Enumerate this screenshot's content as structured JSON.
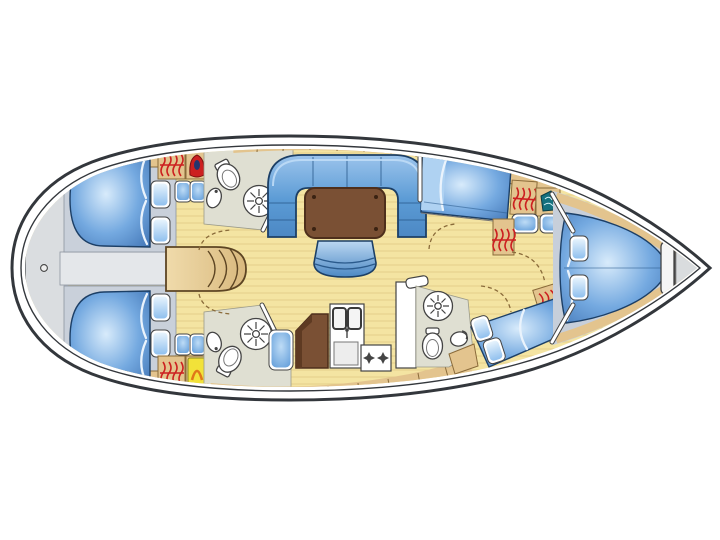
{
  "title": "Sailing yacht interior layout floor plan (top view)",
  "canvas": {
    "width": 720,
    "height": 540,
    "background": "#ffffff"
  },
  "orientation": {
    "bow": "right",
    "stern": "left"
  },
  "colors": {
    "hull_line": "#33373c",
    "floor": "#F4E4A2",
    "floor_plank_line": "#C9AF67",
    "platform": "#DADDE0",
    "bed_base": "#C9D0DA",
    "bed_line": "#1C3F66",
    "tan": "#E3C48E",
    "tan_line": "#8a6b3a",
    "table": "#7A5034",
    "head_floor": "#DFDFD2",
    "red": "#CC2020",
    "yellow": "#F2E239",
    "orange": "#E07818",
    "teal": "#15717E",
    "door_arc": "#8a6b3a"
  },
  "rooms": [
    {
      "id": "stern-platform",
      "name": "stern swim platform",
      "features": [
        "transom curve",
        "deck fitting"
      ]
    },
    {
      "id": "aft-cabin-port",
      "name": "aft double cabin (upper)",
      "features": [
        "double berth",
        "2 pillows",
        "hanging locker",
        "wet locker (red)",
        "2 seat cushions"
      ]
    },
    {
      "id": "aft-cabin-starboard",
      "name": "aft double cabin (lower)",
      "features": [
        "double berth",
        "2 pillows",
        "hanging locker",
        "heater unit (yellow)",
        "2 seat cushions"
      ]
    },
    {
      "id": "aft-head-port",
      "name": "aft head (upper)",
      "features": [
        "toilet",
        "washbasin",
        "shower"
      ]
    },
    {
      "id": "aft-head-starboard",
      "name": "aft head (lower)",
      "features": [
        "toilet",
        "washbasin",
        "shower"
      ]
    },
    {
      "id": "companionway",
      "name": "companionway steps",
      "features": [
        "curved steps"
      ]
    },
    {
      "id": "salon",
      "name": "salon",
      "features": [
        "U-shaped settee",
        "dining table",
        "movable stool"
      ]
    },
    {
      "id": "nav-area",
      "name": "chart table with seat",
      "features": [
        "chart table",
        "seat cushion"
      ]
    },
    {
      "id": "galley",
      "name": "galley",
      "features": [
        "double sink",
        "faucet",
        "two-burner stove",
        "cabinet"
      ]
    },
    {
      "id": "fwd-cabin-port",
      "name": "forward cabin (upper)",
      "features": [
        "double berth",
        "hanging locker",
        "basin (teal)",
        "2 seat cushions",
        "wardrobe"
      ]
    },
    {
      "id": "fwd-head-starboard",
      "name": "forward head (lower)",
      "features": [
        "shower",
        "toilet",
        "washbasin",
        "door"
      ]
    },
    {
      "id": "fwd-cabin-starboard",
      "name": "forward cabin (lower)",
      "features": [
        "double berth",
        "2 pillows",
        "hanging locker"
      ]
    },
    {
      "id": "owner-cabin-bow",
      "name": "bow owner cabin",
      "features": [
        "island double berth",
        "2 pillows",
        "side shelves",
        "headboard"
      ]
    },
    {
      "id": "anchor-locker",
      "name": "anchor locker at bow tip",
      "features": []
    }
  ]
}
